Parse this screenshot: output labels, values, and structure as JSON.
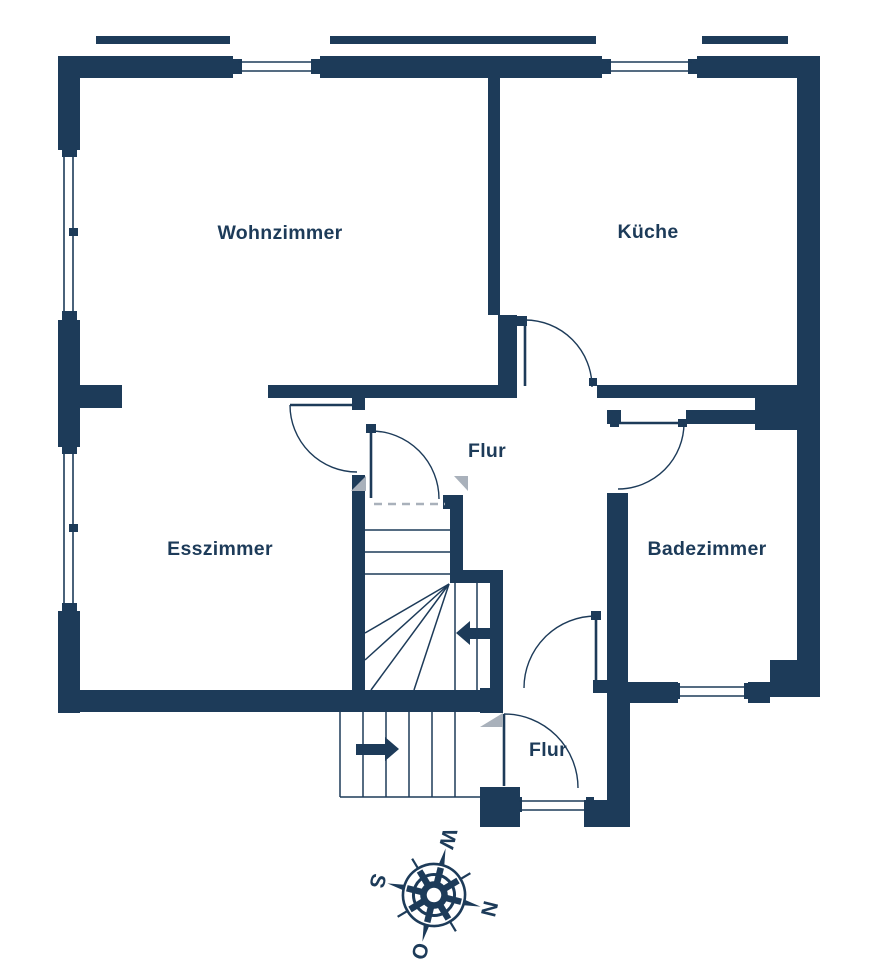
{
  "plan": {
    "type": "floor-plan",
    "rooms": {
      "wohnzimmer": "Wohnzimmer",
      "kueche": "Küche",
      "flur_upper": "Flur",
      "esszimmer": "Esszimmer",
      "badezimmer": "Badezimmer",
      "flur_lower": "Flur"
    }
  },
  "compass": {
    "n": "N",
    "o": "O",
    "s": "S",
    "w": "W",
    "rotation_deg": 104
  },
  "colors": {
    "wall": "#1d3b59",
    "line": "#1d3b59",
    "artifact": "#a9b1bb",
    "background": "#ffffff"
  }
}
